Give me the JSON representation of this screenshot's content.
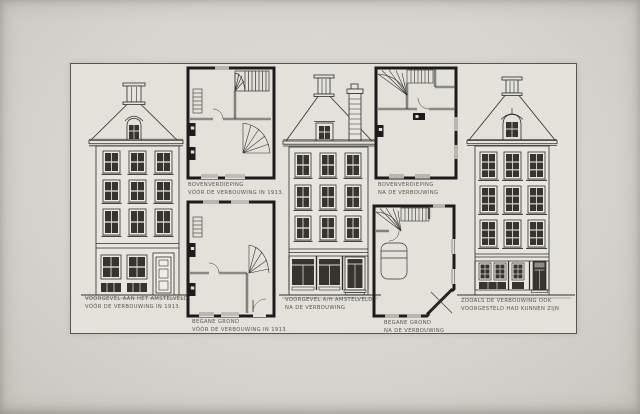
{
  "colors": {
    "paper": "#d7d5cf",
    "sheet": "#e2e1da",
    "ink": "#2e2d29",
    "plan_wall": "#1d1c1a",
    "glass": "#35342f",
    "caption_ink": "#4b4a43"
  },
  "panels": [
    {
      "id": "facade-before",
      "kind": "elevation",
      "caption": [
        "VOORGEVEL AAN HET AMSTELVELD.",
        "VÓÓR DE VERBOUWING IN 1913."
      ]
    },
    {
      "id": "plan-upper-before",
      "kind": "floor-plan",
      "caption": [
        "BOVENVERDIEPING",
        "VÓÓR DE VERBOUWING IN 1913."
      ]
    },
    {
      "id": "plan-ground-before",
      "kind": "floor-plan",
      "caption": [
        "BEGANE GROND",
        "VÓÓR DE VERBOUWING IN 1913."
      ]
    },
    {
      "id": "facade-after",
      "kind": "elevation",
      "caption": [
        "VOORGEVEL A/H AMSTELVELD",
        "NA DE VERBOUWING"
      ]
    },
    {
      "id": "plan-upper-after",
      "kind": "floor-plan",
      "caption": [
        "BOVENVERDIEPING",
        "NA DE VERBOUWING"
      ]
    },
    {
      "id": "plan-ground-after",
      "kind": "floor-plan",
      "caption": [
        "BEGANE GROND",
        "NA DE VERBOUWING"
      ]
    },
    {
      "id": "facade-proposal",
      "kind": "elevation",
      "caption": [
        "ZOOALS DE VERBOUWING OOK",
        "VOORGESTELD HAD KUNNEN ZIJN"
      ]
    }
  ]
}
